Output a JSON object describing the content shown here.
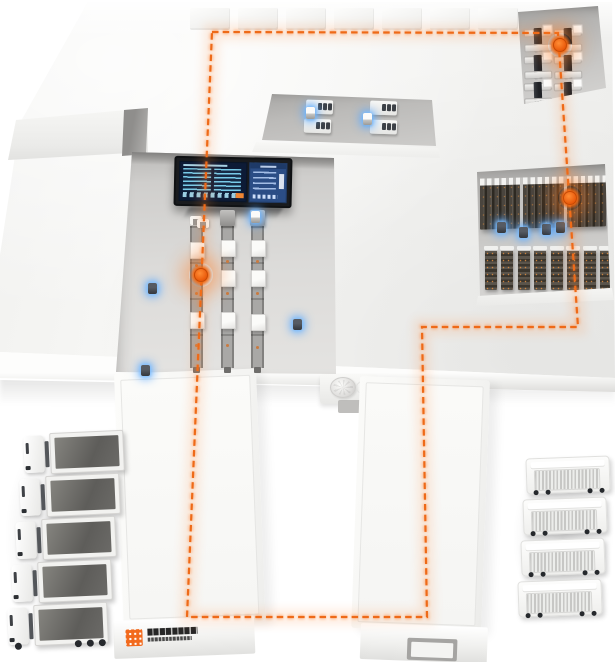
{
  "meta": {
    "title": "Smart warehouse logistics isometric illustration"
  },
  "palette": {
    "background": "#ffffff",
    "accent_orange": "#ee6a18",
    "route_glow": "#ff8a3c",
    "agv_glow_blue": "#57a8ff",
    "screen_navy": "#0d1b36",
    "screen_blue": "#2b4d85",
    "screen_cyan": "#7fd4f2",
    "rack_dark": "#37332e",
    "logo_orange": "#f26a1d"
  },
  "route": {
    "style": "dashed",
    "color": "#ee6a18",
    "closed": true,
    "points": [
      [
        212,
        32
      ],
      [
        558,
        33
      ],
      [
        578,
        327
      ],
      [
        422,
        327
      ],
      [
        427,
        617
      ],
      [
        187,
        617
      ]
    ]
  },
  "markers": [
    [
      560,
      45
    ],
    [
      570,
      198
    ],
    [
      201,
      275
    ]
  ],
  "agvs": [
    {
      "x": 148,
      "y": 283,
      "t": "dark"
    },
    {
      "x": 293,
      "y": 319,
      "t": "dark"
    },
    {
      "x": 141,
      "y": 365,
      "t": "dark"
    },
    {
      "x": 251,
      "y": 211,
      "t": "light"
    },
    {
      "x": 197,
      "y": 219,
      "t": "bracket"
    },
    {
      "x": 306,
      "y": 107,
      "t": "light"
    },
    {
      "x": 363,
      "y": 113,
      "t": "light"
    },
    {
      "x": 497,
      "y": 222,
      "t": "dark"
    },
    {
      "x": 519,
      "y": 227,
      "t": "dark"
    },
    {
      "x": 542,
      "y": 224,
      "t": "dark"
    },
    {
      "x": 556,
      "y": 222,
      "t": "dark"
    }
  ],
  "roof_units": {
    "count": 7,
    "x": 190,
    "y": 8,
    "w": 40,
    "h": 22,
    "gap": 8
  },
  "zones": {
    "receiving_bay": {
      "machines": {
        "cols": [
          8,
          38
        ],
        "rows": [
          24,
          51,
          78
        ]
      }
    },
    "workstation_bay": {
      "stations": [
        [
          306,
          100
        ],
        [
          304,
          119
        ],
        [
          370,
          101
        ],
        [
          370,
          120
        ]
      ]
    },
    "sorting_hall": {
      "conveyors": [
        {
          "x": 190,
          "y": 226,
          "h": 142,
          "head": "u",
          "boxes": [
            16,
            86
          ],
          "dots": [
            38,
            66,
            118
          ]
        },
        {
          "x": 221,
          "y": 226,
          "h": 142,
          "head": "block",
          "boxes": [
            14,
            44,
            86
          ],
          "dots": [
            34,
            66,
            118
          ]
        },
        {
          "x": 251,
          "y": 226,
          "h": 142,
          "head": "block",
          "boxes": [
            14,
            44,
            88
          ],
          "dots": [
            34,
            66,
            120
          ]
        }
      ]
    },
    "storage_bay": {
      "rack_row_gaps": [
        40,
        84
      ],
      "rack_stacks": 8
    }
  },
  "fleets": {
    "left_trucks": {
      "count": 5,
      "type": "open-bed-truck",
      "rotation": -2.5,
      "positions": [
        [
          24,
          432
        ],
        [
          20,
          475
        ],
        [
          16,
          518
        ],
        [
          12,
          561
        ],
        [
          8,
          604
        ]
      ],
      "wheel_offsets": [
        6,
        46,
        58,
        70
      ]
    },
    "right_vans": {
      "count": 4,
      "type": "box-van",
      "rotation": -2,
      "positions": [
        [
          526,
          457
        ],
        [
          523,
          498
        ],
        [
          521,
          539
        ],
        [
          518,
          580
        ]
      ],
      "wheel_offsets": [
        6,
        18,
        60,
        72
      ]
    }
  },
  "logo": {
    "mark_color": "#f26a1d",
    "mark_style": "pixel-grid-square",
    "wordmark": "illegible dark two-line wordmark"
  },
  "dashboard": {
    "panels": [
      "data-table-left",
      "data-table-right",
      "status-panel"
    ],
    "text": "illegible"
  }
}
